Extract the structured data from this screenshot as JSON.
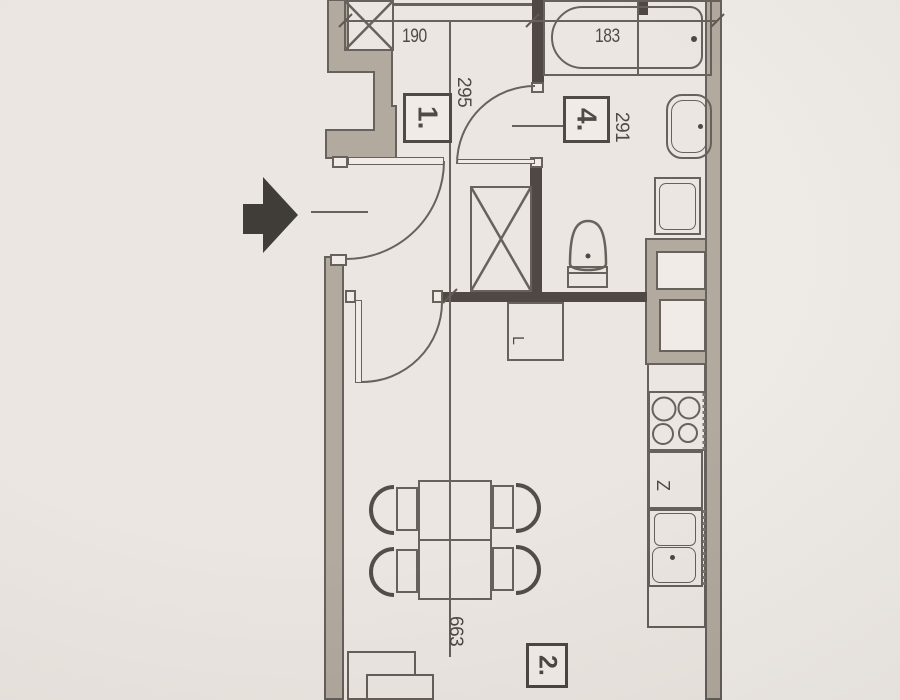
{
  "floorplan": {
    "title": "apartment-floor-plan-scan",
    "rooms": [
      {
        "label": "1.",
        "role": "hallway"
      },
      {
        "label": "4.",
        "role": "bathroom"
      },
      {
        "label": "2.",
        "role": "living-room-with-kitchen"
      }
    ],
    "dimensions": {
      "hall_width": "190",
      "bath_width": "183",
      "hall_depth": "295",
      "bath_depth": "291",
      "living_length": "663"
    },
    "appliances": {
      "dishwasher_label": "Z",
      "fridge_label": "L"
    },
    "colors": {
      "paper": "#e9e3df",
      "wall_gray": "#a9a095",
      "wall_black": "#3b3430",
      "linework": "#57504a"
    }
  }
}
